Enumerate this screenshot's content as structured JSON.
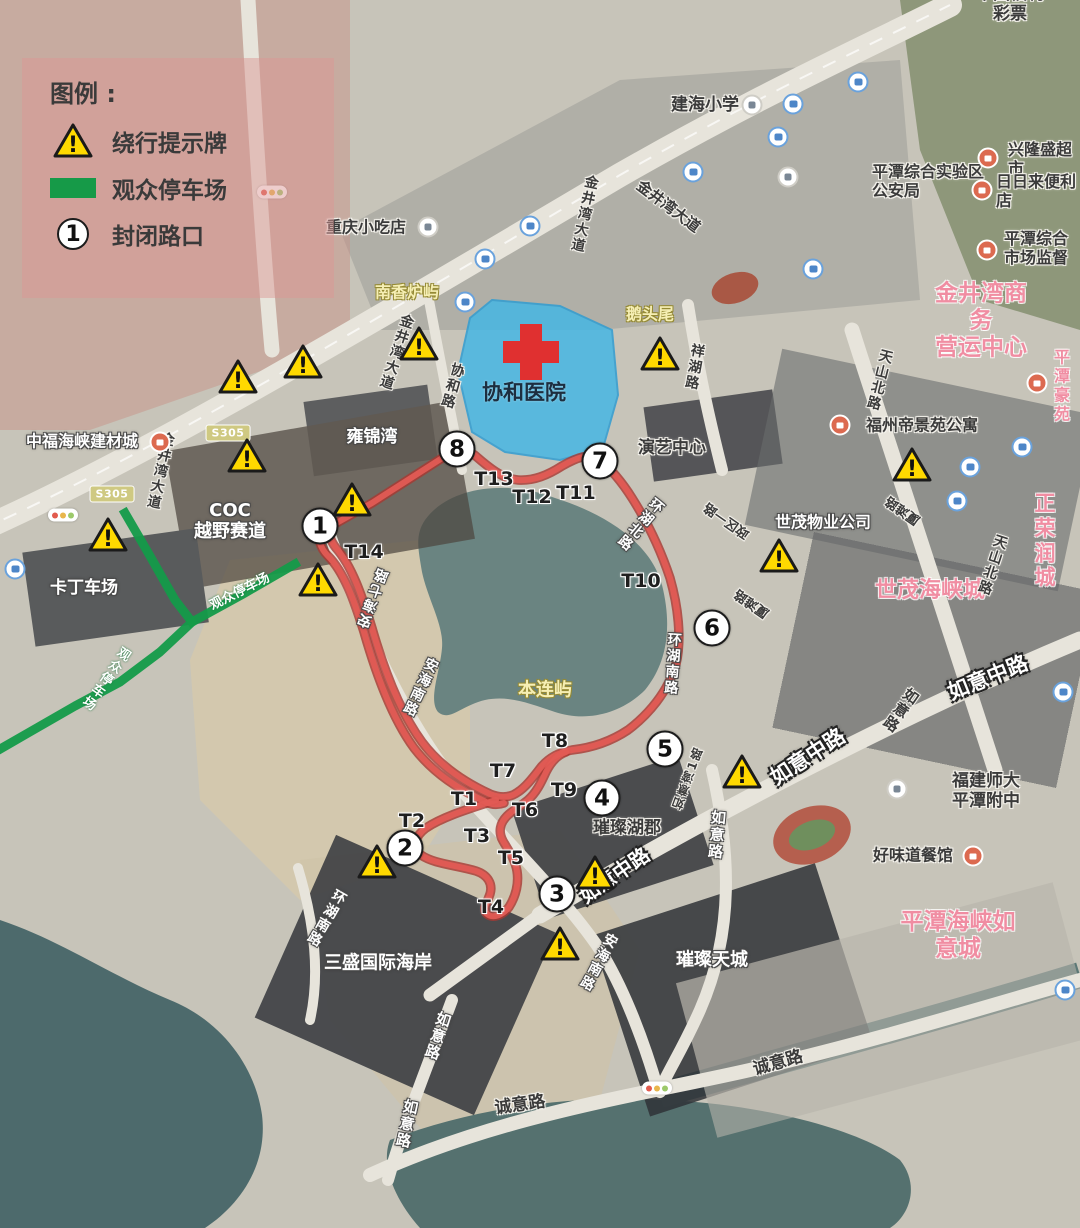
{
  "legend": {
    "title": "图例 :",
    "items": [
      {
        "icon": "warning-triangle-icon",
        "label": "绕行提示牌"
      },
      {
        "icon": "parking-route-swatch",
        "label": "观众停车场"
      },
      {
        "icon": "closed-intersection-badge",
        "number": "1",
        "label": "封闭路口"
      }
    ]
  },
  "colors": {
    "route_red": "#e15b54",
    "route_edge": "#a83832",
    "parking_green": "#149b49",
    "hospital_fill": "#41b6e6",
    "warning_yellow": "#ffd900",
    "brand_pink": "#f08da2"
  },
  "hospital": {
    "name": "协和医院"
  },
  "map": {
    "route_paths": [
      "M 330,524 C 326,530 330,540 336,548 C 352,566 362,596 372,628 C 384,670 400,712 422,742 C 440,766 464,782 490,794 C 500,798 510,798 518,792 C 527,786 534,776 542,766 C 550,757 560,752 572,750 C 590,748 610,742 628,730 C 648,715 668,692 676,664 C 682,638 678,606 670,578 C 660,548 646,520 632,498 C 622,482 610,468 600,460 C 590,452 576,458 562,466 C 548,475 534,481 518,480 C 504,479 492,470 478,458 C 470,450 460,448 450,453 L 372,503 L 324,530",
      "M 322,528 C 316,536 320,548 328,556 C 344,572 354,600 364,632 C 376,674 392,718 414,748 C 434,774 460,790 486,802 C 492,805 498,805 504,803",
      "M 496,800 C 472,808 444,816 426,828 C 414,837 412,848 421,855 C 434,864 456,865 476,871 C 488,875 493,884 490,894 C 487,903 482,909 487,914 C 493,919 503,915 509,907 C 516,896 519,883 517,871 C 515,859 508,850 503,841 C 498,832 500,823 507,816 C 513,810 521,806 528,800 C 536,793 541,783 546,772 C 551,762 557,755 566,752"
    ],
    "parking_paths": [
      "M 125,513 L 150,556 L 175,600 L 192,622 L 160,652 L 120,682 L 75,706 L 28,733 L -5,752",
      "M 192,622 L 243,594 L 295,564"
    ],
    "hospital_polygon": "M 492,300 L 560,306 L 612,330 L 618,395 L 603,448 L 560,460 L 505,452 L 472,432 L 458,372 L 470,318 Z",
    "closed_intersections": [
      {
        "number": "1",
        "x": 320,
        "y": 526
      },
      {
        "number": "2",
        "x": 405,
        "y": 848
      },
      {
        "number": "3",
        "x": 557,
        "y": 894
      },
      {
        "number": "4",
        "x": 602,
        "y": 798
      },
      {
        "number": "5",
        "x": 665,
        "y": 749
      },
      {
        "number": "6",
        "x": 712,
        "y": 628
      },
      {
        "number": "7",
        "x": 600,
        "y": 461
      },
      {
        "number": "8",
        "x": 457,
        "y": 449
      }
    ],
    "turns": [
      {
        "label": "T1",
        "x": 464,
        "y": 799
      },
      {
        "label": "T2",
        "x": 412,
        "y": 821
      },
      {
        "label": "T3",
        "x": 477,
        "y": 836
      },
      {
        "label": "T4",
        "x": 491,
        "y": 907
      },
      {
        "label": "T5",
        "x": 511,
        "y": 858
      },
      {
        "label": "T6",
        "x": 525,
        "y": 810
      },
      {
        "label": "T7",
        "x": 503,
        "y": 771
      },
      {
        "label": "T8",
        "x": 555,
        "y": 741
      },
      {
        "label": "T9",
        "x": 564,
        "y": 790
      },
      {
        "label": "T10",
        "x": 641,
        "y": 581
      },
      {
        "label": "T11",
        "x": 576,
        "y": 493
      },
      {
        "label": "T12",
        "x": 532,
        "y": 497
      },
      {
        "label": "T13",
        "x": 494,
        "y": 479
      },
      {
        "label": "T14",
        "x": 364,
        "y": 552
      }
    ],
    "warnings": [
      {
        "x": 238,
        "y": 377
      },
      {
        "x": 303,
        "y": 362
      },
      {
        "x": 419,
        "y": 344
      },
      {
        "x": 660,
        "y": 354
      },
      {
        "x": 247,
        "y": 456
      },
      {
        "x": 108,
        "y": 535
      },
      {
        "x": 352,
        "y": 500
      },
      {
        "x": 318,
        "y": 580
      },
      {
        "x": 912,
        "y": 465
      },
      {
        "x": 779,
        "y": 556
      },
      {
        "x": 742,
        "y": 772
      },
      {
        "x": 595,
        "y": 873
      },
      {
        "x": 560,
        "y": 944
      },
      {
        "x": 377,
        "y": 862
      }
    ],
    "labels": [
      {
        "t": "建海小学",
        "x": 705,
        "y": 105,
        "s": "dark",
        "size": 17
      },
      {
        "t": "平潭综合实验区\n公安局",
        "x": 872,
        "y": 182,
        "s": "dark",
        "size": 16,
        "align": "left"
      },
      {
        "t": "兴隆盛超市",
        "x": 1008,
        "y": 160,
        "s": "dark",
        "size": 16,
        "align": "left"
      },
      {
        "t": "日日来便利店",
        "x": 996,
        "y": 192,
        "s": "dark",
        "size": 16,
        "align": "left"
      },
      {
        "t": "平潭综合\n市场监督",
        "x": 1004,
        "y": 249,
        "s": "dark",
        "size": 16,
        "align": "left"
      },
      {
        "t": "中国福利彩票",
        "x": 1010,
        "y": 4,
        "s": "dark",
        "size": 17
      },
      {
        "t": "金井湾商务\n营运中心",
        "x": 981,
        "y": 321,
        "s": "pink",
        "size": 23
      },
      {
        "t": "重庆小吃店",
        "x": 366,
        "y": 228,
        "s": "dark",
        "size": 16
      },
      {
        "t": "南香炉屿",
        "x": 407,
        "y": 293,
        "s": "yellow",
        "size": 16
      },
      {
        "t": "鹅头尾",
        "x": 650,
        "y": 315,
        "s": "yellow",
        "size": 16
      },
      {
        "t": "协和医院",
        "x": 524,
        "y": 393,
        "s": "hospital",
        "size": 21
      },
      {
        "t": "协和路",
        "x": 452,
        "y": 386,
        "s": "dark",
        "size": 14,
        "vert": true,
        "rot": 16
      },
      {
        "t": "祥湖路",
        "x": 694,
        "y": 367,
        "s": "dark",
        "size": 14,
        "vert": true,
        "rot": 10
      },
      {
        "t": "演艺中心",
        "x": 672,
        "y": 448,
        "s": "dark",
        "size": 17
      },
      {
        "t": "雍锦湾",
        "x": 372,
        "y": 437,
        "s": "white",
        "size": 17
      },
      {
        "t": "中福海峡建材城",
        "x": 82,
        "y": 442,
        "s": "white",
        "size": 16
      },
      {
        "t": "COC\n越野赛道",
        "x": 230,
        "y": 521,
        "s": "white",
        "size": 18
      },
      {
        "t": "卡丁车场",
        "x": 84,
        "y": 588,
        "s": "white",
        "size": 17
      },
      {
        "t": "世茂物业公司",
        "x": 823,
        "y": 523,
        "s": "white",
        "size": 16
      },
      {
        "t": "福州帝景苑公寓",
        "x": 922,
        "y": 426,
        "s": "dark",
        "size": 16
      },
      {
        "t": "平潭\n豪苑",
        "x": 1054,
        "y": 386,
        "s": "pink",
        "size": 16,
        "align": "left"
      },
      {
        "t": "正荣润城",
        "x": 1045,
        "y": 541,
        "s": "pink",
        "size": 21
      },
      {
        "t": "世茂海峡城",
        "x": 930,
        "y": 591,
        "s": "pink",
        "size": 22
      },
      {
        "t": "天山北路",
        "x": 879,
        "y": 380,
        "s": "dark",
        "size": 14,
        "vert": true,
        "rot": 14
      },
      {
        "t": "天山北路",
        "x": 992,
        "y": 565,
        "s": "dark",
        "size": 14,
        "vert": true,
        "rot": 18
      },
      {
        "t": "金井湾大道",
        "x": 668,
        "y": 207,
        "s": "dark",
        "size": 15,
        "rot": 37
      },
      {
        "t": "金井湾大道",
        "x": 584,
        "y": 214,
        "s": "dark",
        "size": 14,
        "vert": true,
        "rot": 12
      },
      {
        "t": "金井湾大道",
        "x": 396,
        "y": 352,
        "s": "dark",
        "size": 14,
        "vert": true,
        "rot": 18
      },
      {
        "t": "金井湾大道",
        "x": 160,
        "y": 471,
        "s": "dark",
        "size": 14,
        "vert": true,
        "rot": 12
      },
      {
        "t": "环湖北路",
        "x": 640,
        "y": 524,
        "s": "white",
        "size": 14,
        "vert": true,
        "rot": 40
      },
      {
        "t": "环湖南路",
        "x": 672,
        "y": 664,
        "s": "white",
        "size": 14,
        "vert": true,
        "rot": 4
      },
      {
        "t": "环湖南路",
        "x": 326,
        "y": 918,
        "s": "white",
        "size": 14,
        "vert": true,
        "rot": 30
      },
      {
        "t": "安海南路",
        "x": 420,
        "y": 687,
        "s": "white",
        "size": 14,
        "vert": true,
        "rot": 25
      },
      {
        "t": "安海南路",
        "x": 598,
        "y": 962,
        "s": "white",
        "size": 14,
        "vert": true,
        "rot": 28
      },
      {
        "t": "安海七路",
        "x": 374,
        "y": 598,
        "s": "white",
        "size": 14,
        "vert": true,
        "rot": 200
      },
      {
        "t": "本连屿",
        "x": 545,
        "y": 690,
        "s": "yellow",
        "size": 18
      },
      {
        "t": "璀璨湖郡",
        "x": 627,
        "y": 828,
        "s": "dark",
        "size": 17
      },
      {
        "t": "璀璨天城",
        "x": 712,
        "y": 960,
        "s": "white",
        "size": 18
      },
      {
        "t": "三盛国际海岸",
        "x": 378,
        "y": 963,
        "s": "white",
        "size": 18
      },
      {
        "t": "平潭海峡如意城",
        "x": 958,
        "y": 936,
        "s": "pink",
        "size": 23
      },
      {
        "t": "如意中路",
        "x": 615,
        "y": 876,
        "s": "whiteBig",
        "size": 20,
        "rot": -35
      },
      {
        "t": "如意中路",
        "x": 808,
        "y": 757,
        "s": "whiteBig",
        "size": 21,
        "rot": -33
      },
      {
        "t": "如意中路",
        "x": 988,
        "y": 678,
        "s": "whiteBig",
        "size": 21,
        "rot": -22
      },
      {
        "t": "如意路",
        "x": 900,
        "y": 710,
        "s": "dark",
        "size": 15,
        "vert": true,
        "rot": 35
      },
      {
        "t": "如意路",
        "x": 716,
        "y": 835,
        "s": "white",
        "size": 15,
        "vert": true,
        "rot": 5
      },
      {
        "t": "如意路",
        "x": 437,
        "y": 1036,
        "s": "white",
        "size": 15,
        "vert": true,
        "rot": 18
      },
      {
        "t": "如意路",
        "x": 406,
        "y": 1124,
        "s": "white",
        "size": 15,
        "vert": true,
        "rot": 12
      },
      {
        "t": "如意湾1路",
        "x": 688,
        "y": 778,
        "s": "dark",
        "size": 12,
        "vert": true,
        "rot": 200
      },
      {
        "t": "厦滩路",
        "x": 903,
        "y": 510,
        "s": "dark",
        "size": 13,
        "rot": 215
      },
      {
        "t": "厦滩路",
        "x": 752,
        "y": 603,
        "s": "dark",
        "size": 13,
        "rot": 215
      },
      {
        "t": "政区一路",
        "x": 727,
        "y": 520,
        "s": "dark",
        "size": 13,
        "rot": 215
      },
      {
        "t": "诚意路",
        "x": 520,
        "y": 1105,
        "s": "dark",
        "size": 17,
        "rot": -8
      },
      {
        "t": "诚意路",
        "x": 778,
        "y": 1063,
        "s": "dark",
        "size": 17,
        "rot": -16
      },
      {
        "t": "福建师大\n平潭附中",
        "x": 952,
        "y": 791,
        "s": "dark",
        "size": 17,
        "align": "left"
      },
      {
        "t": "好味道餐馆",
        "x": 913,
        "y": 856,
        "s": "dark",
        "size": 16
      },
      {
        "t": "观众停车场",
        "x": 240,
        "y": 592,
        "s": "green",
        "size": 13,
        "rot": -27
      },
      {
        "t": "观众停车场",
        "x": 105,
        "y": 678,
        "s": "green",
        "size": 13,
        "vert": true,
        "rot": 35
      }
    ],
    "s305_badges": [
      {
        "text": "S305",
        "x": 228,
        "y": 433
      },
      {
        "text": "S305",
        "x": 112,
        "y": 494
      }
    ],
    "bus_stops": [
      {
        "x": 793,
        "y": 104
      },
      {
        "x": 858,
        "y": 82
      },
      {
        "x": 778,
        "y": 137
      },
      {
        "x": 693,
        "y": 172
      },
      {
        "x": 813,
        "y": 269
      },
      {
        "x": 530,
        "y": 226
      },
      {
        "x": 485,
        "y": 259
      },
      {
        "x": 465,
        "y": 302
      },
      {
        "x": 15,
        "y": 569
      },
      {
        "x": 1022,
        "y": 447
      },
      {
        "x": 970,
        "y": 467
      },
      {
        "x": 957,
        "y": 501
      },
      {
        "x": 1063,
        "y": 692
      },
      {
        "x": 1065,
        "y": 990
      }
    ],
    "shops": [
      {
        "x": 988,
        "y": 158
      },
      {
        "x": 982,
        "y": 190
      },
      {
        "x": 987,
        "y": 250
      },
      {
        "x": 973,
        "y": 856
      },
      {
        "x": 840,
        "y": 425
      },
      {
        "x": 1037,
        "y": 383
      },
      {
        "x": 160,
        "y": 442
      }
    ],
    "civic_icons": [
      {
        "x": 428,
        "y": 227
      },
      {
        "x": 788,
        "y": 177
      },
      {
        "x": 752,
        "y": 105
      },
      {
        "x": 897,
        "y": 789
      }
    ],
    "traffic_lights": [
      {
        "x": 272,
        "y": 192
      },
      {
        "x": 63,
        "y": 515
      },
      {
        "x": 657,
        "y": 1088
      }
    ]
  }
}
